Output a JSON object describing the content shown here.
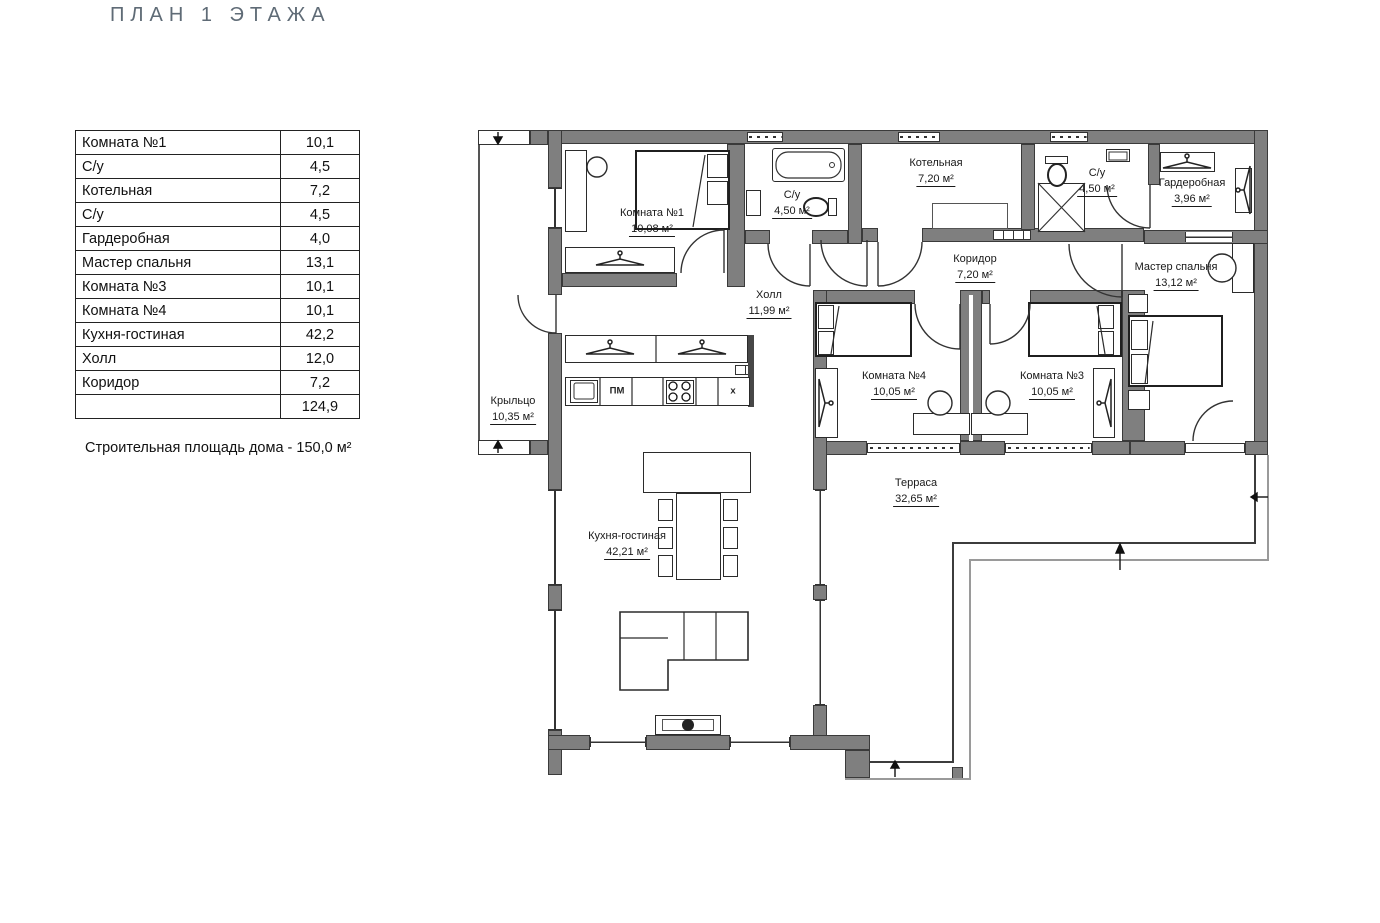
{
  "title": "ПЛАН 1 ЭТАЖА",
  "area_table": {
    "rows": [
      {
        "label": "Комната №1",
        "value": "10,1"
      },
      {
        "label": "С/у",
        "value": "4,5"
      },
      {
        "label": "Котельная",
        "value": "7,2"
      },
      {
        "label": "С/у",
        "value": "4,5"
      },
      {
        "label": "Гардеробная",
        "value": "4,0"
      },
      {
        "label": "Мастер спальня",
        "value": "13,1"
      },
      {
        "label": "Комната №3",
        "value": "10,1"
      },
      {
        "label": "Комната №4",
        "value": "10,1"
      },
      {
        "label": "Кухня-гостиная",
        "value": "42,2"
      },
      {
        "label": "Холл",
        "value": "12,0"
      },
      {
        "label": "Коридор",
        "value": "7,2"
      }
    ],
    "total": "124,9"
  },
  "note": "Строительная площадь дома - 150,0 м²",
  "plan": {
    "rooms": [
      {
        "name": "Комната №1",
        "area": "10,08 м²"
      },
      {
        "name": "С/у",
        "area": "4,50 м²"
      },
      {
        "name": "Котельная",
        "area": "7,20 м²"
      },
      {
        "name": "С/у",
        "area": "4,50 м²"
      },
      {
        "name": "Гардеробная",
        "area": "3,96 м²"
      },
      {
        "name": "Коридор",
        "area": "7,20 м²"
      },
      {
        "name": "Мастер спальня",
        "area": "13,12 м²"
      },
      {
        "name": "Холл",
        "area": "11,99 м²"
      },
      {
        "name": "Комната №4",
        "area": "10,05 м²"
      },
      {
        "name": "Комната №3",
        "area": "10,05 м²"
      },
      {
        "name": "Кухня-гостиная",
        "area": "42,21 м²"
      },
      {
        "name": "Крыльцо",
        "area": "10,35 м²"
      },
      {
        "name": "Терраса",
        "area": "32,65 м²"
      }
    ],
    "kitchen": {
      "dishwasher": "ПМ",
      "fridge": "х"
    }
  },
  "colors": {
    "wall": "#7f7f7f",
    "line": "#333333",
    "title": "#5f6b76"
  }
}
